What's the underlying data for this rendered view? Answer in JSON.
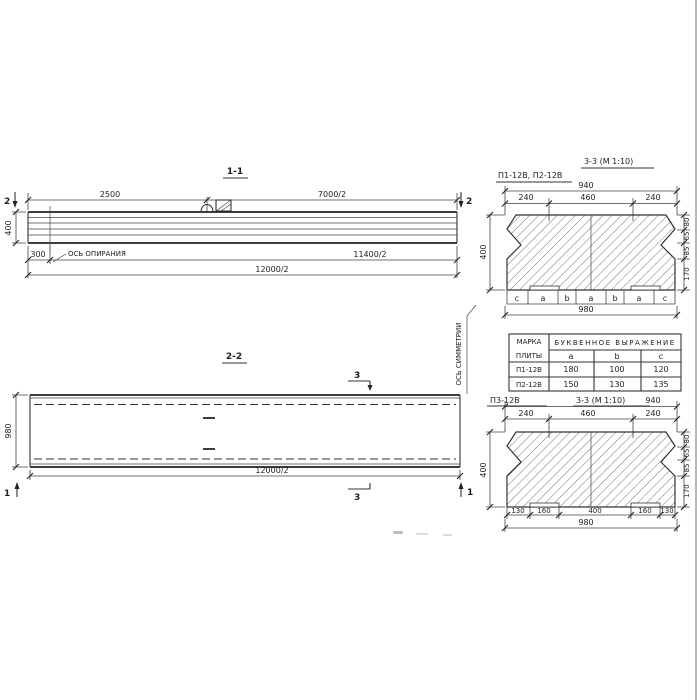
{
  "s11": {
    "title": "1-1",
    "mark": "2",
    "d2500": "2500",
    "d7000": "7000/2",
    "d400": "400",
    "d300": "300",
    "support": "ОСЬ ОПИРАНИЯ",
    "d11400": "11400/2",
    "d12000": "12000/2"
  },
  "s22": {
    "title": "2-2",
    "mark3": "3",
    "mark1": "1",
    "d980": "980",
    "d12000": "12000/2",
    "symmetry": "ОСЬ СИММЕТРИИ"
  },
  "s33a": {
    "label": "П1-12В, П2-12В",
    "title": "3-3 (М 1:10)",
    "d940": "940",
    "t240a": "240",
    "t460": "460",
    "t240b": "240",
    "d400": "400",
    "r80": "80",
    "r65": "65",
    "r85": "85",
    "r170": "170",
    "letters": [
      "c",
      "a",
      "b",
      "a",
      "b",
      "a",
      "c"
    ],
    "d980": "980"
  },
  "table": {
    "mark1": "МАРКА",
    "mark2": "ПЛИТЫ",
    "expr": "БУКВЕННОЕ  ВЫРАЖЕНИЕ",
    "ca": "a",
    "cb": "b",
    "cc": "c",
    "rows": [
      [
        "П1-12В",
        "180",
        "100",
        "120"
      ],
      [
        "П2-12В",
        "150",
        "130",
        "135"
      ]
    ]
  },
  "s33b": {
    "label": "П3-12В",
    "title": "3-3 (М 1:10)",
    "d940": "940",
    "t240a": "240",
    "t460": "460",
    "t240b": "240",
    "d400": "400",
    "r80": "80",
    "r65": "65",
    "r85": "85",
    "r170": "170",
    "b130a": "130",
    "b160a": "160",
    "b400": "400",
    "b160b": "160",
    "b130b": "130",
    "d980": "980"
  }
}
